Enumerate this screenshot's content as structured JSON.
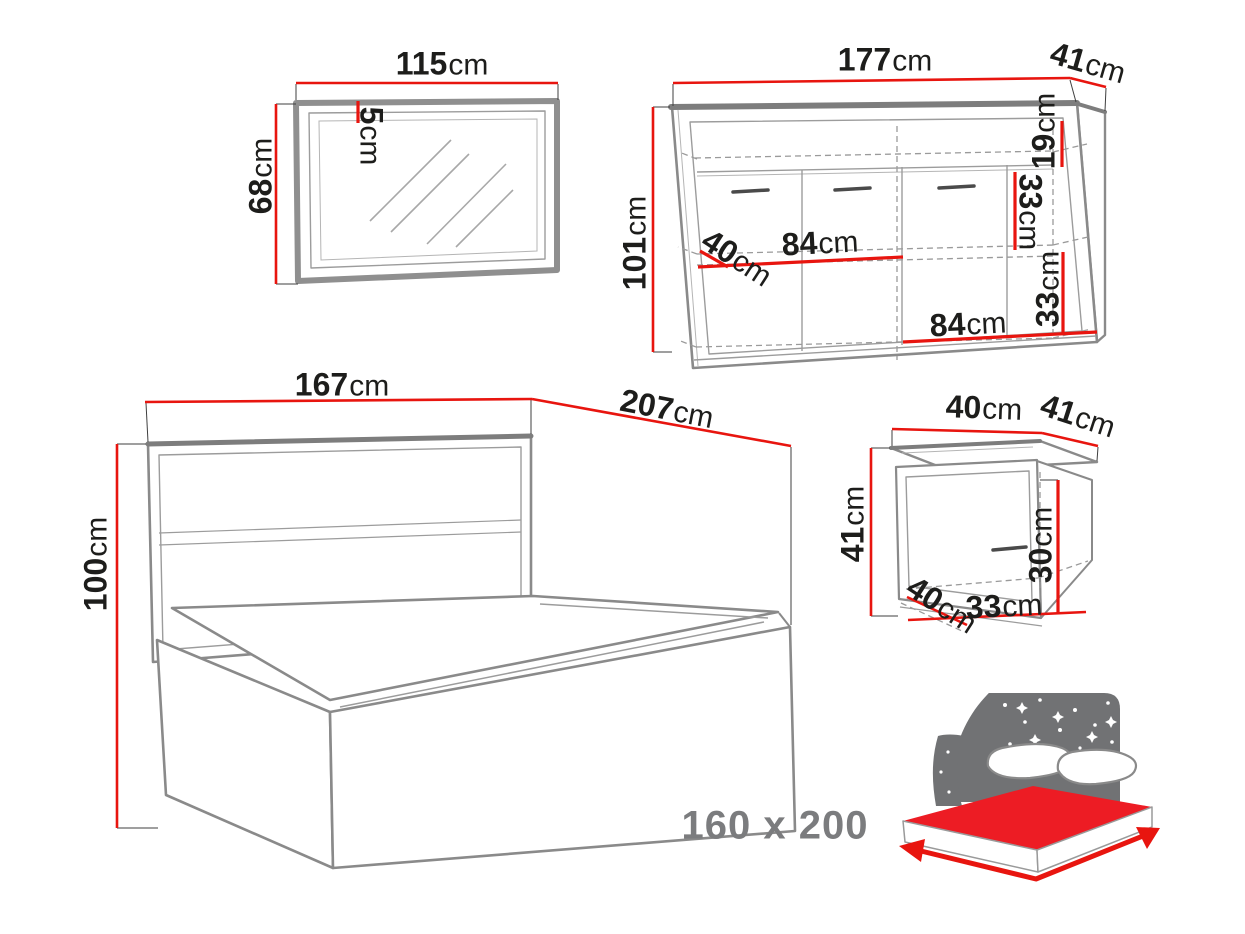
{
  "palette": {
    "dimension_red": "#e8150f",
    "mattress_red": "#ed1c24",
    "text_dark": "#1d1d1b",
    "line_gray": "#8a8a8a",
    "dark_gray": "#7d7d7d",
    "thin_gray": "#9c9c9c",
    "icon_gray": "#717274",
    "label_gray": "#7b7c7e"
  },
  "unit": "cm",
  "mirror": {
    "width": "115",
    "height": "68",
    "frame_thickness": "5"
  },
  "sideboard": {
    "width": "177",
    "depth": "41",
    "height": "101",
    "top_section_height": "19",
    "middle_section_height": "33",
    "bottom_section_height": "33",
    "left_compartment_width": "84",
    "right_compartment_width": "84",
    "interior_depth": "40"
  },
  "bed": {
    "headboard_width": "167",
    "length": "207",
    "headboard_height": "100",
    "mattress_size": "160 x 200"
  },
  "nightstand": {
    "width": "40",
    "depth": "41",
    "height": "41",
    "interior_height": "30",
    "interior_width": "33",
    "interior_depth": "40"
  }
}
